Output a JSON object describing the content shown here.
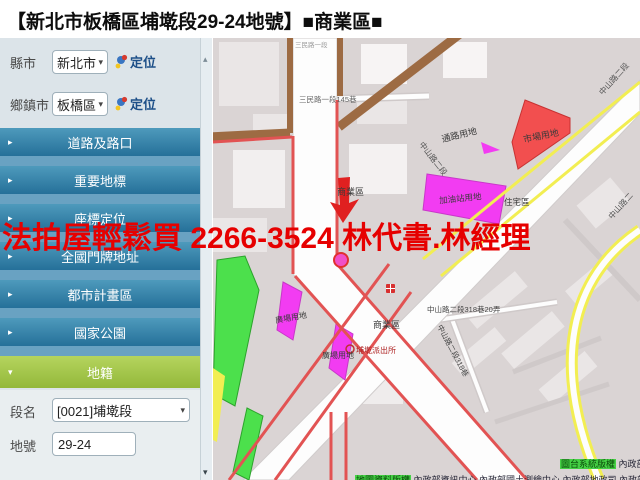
{
  "title": "【新北市板橋區埔墘段29-24地號】■商業區■",
  "ad_overlay": "法拍屋輕鬆買  2266-3524  林代書.林經理",
  "sidebar": {
    "county_label": "縣市",
    "county_value": "新北市",
    "township_label": "鄉鎮市",
    "township_value": "板橋區",
    "locate_label": "定位",
    "menu": [
      {
        "label": "道路及路口"
      },
      {
        "label": "重要地標"
      },
      {
        "label": "座標定位"
      },
      {
        "label": "全國門牌地址"
      },
      {
        "label": "都市計畫區"
      },
      {
        "label": "國家公園"
      },
      {
        "label": "地籍",
        "active": true
      }
    ],
    "form": {
      "section_label": "段名",
      "section_value": "[0021]埔墘段",
      "parcel_label": "地號",
      "parcel_value": "29-24"
    }
  },
  "map": {
    "labels": [
      {
        "text": "通路用地"
      },
      {
        "text": "中山路二段"
      },
      {
        "text": "市場用地"
      },
      {
        "text": "住宅區"
      },
      {
        "text": "加油站用地"
      },
      {
        "text": "商業區"
      },
      {
        "text": "商業區"
      },
      {
        "text": "廣場用地"
      },
      {
        "text": "廣場用地"
      },
      {
        "text": "中山路二段"
      },
      {
        "text": "中山路二"
      },
      {
        "text": "中山路二段318巷20弄"
      },
      {
        "text": "中山路二段318巷"
      },
      {
        "text": "三民路一段145巷"
      },
      {
        "text": "三民路一段"
      },
      {
        "text": "埔墘派出所"
      }
    ],
    "copyright": {
      "sys_label": "圖台系統版權",
      "sys_text": "內政部資訊中心",
      "data_label": "地圖資料版權",
      "data_text": "內政部資訊中心 內政部國土測繪中心 內政部地政司 內政部地政司",
      "line3": "交通部運輸研究所 農委會林務局農林航空測量所 內政部營建署各國家公園管理處 各縣市政府"
    },
    "colors": {
      "commercial_outline": "#e25353",
      "market_zone": "#f24f4f",
      "gas_station_zone": "#f23cf2",
      "park_zone": "#4ce04c",
      "residential_zone": "#f2ee52",
      "major_road": "#9d6b43",
      "menu_teal": "#2c7ba3",
      "menu_green": "#a3c24c",
      "ad_red": "#e60000"
    }
  }
}
